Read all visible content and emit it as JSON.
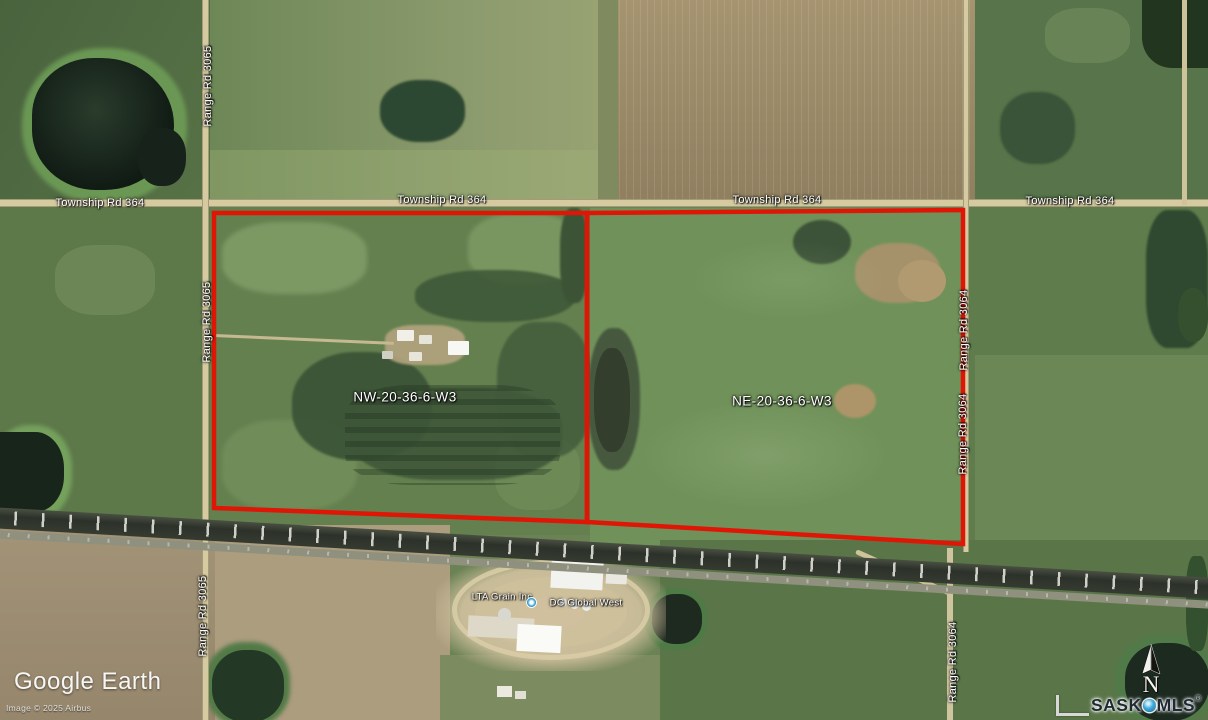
{
  "map": {
    "road_labels": {
      "township": "Township Rd 364",
      "range_west": "Range Rd 3065",
      "range_east": "Range Rd 3064"
    },
    "parcels": [
      {
        "label": "NW-20-36-6-W3"
      },
      {
        "label": "NE-20-36-6-W3"
      }
    ],
    "pois": [
      {
        "label": "LTA Grain Inc"
      },
      {
        "label": "DG Global West"
      }
    ],
    "boundary_color": "#df1505"
  },
  "branding": {
    "google_earth_logo": "Google Earth",
    "imagery_credit": "Image © 2025 Airbus",
    "mls_logo": {
      "sask": "SASK",
      "mls": "MLS",
      "registered": "®"
    },
    "north_indicator": "N"
  },
  "colors": {
    "label_text": "#ffffff",
    "mls_blue": "#2e9fd4",
    "road_tan": "#d6cba0"
  }
}
